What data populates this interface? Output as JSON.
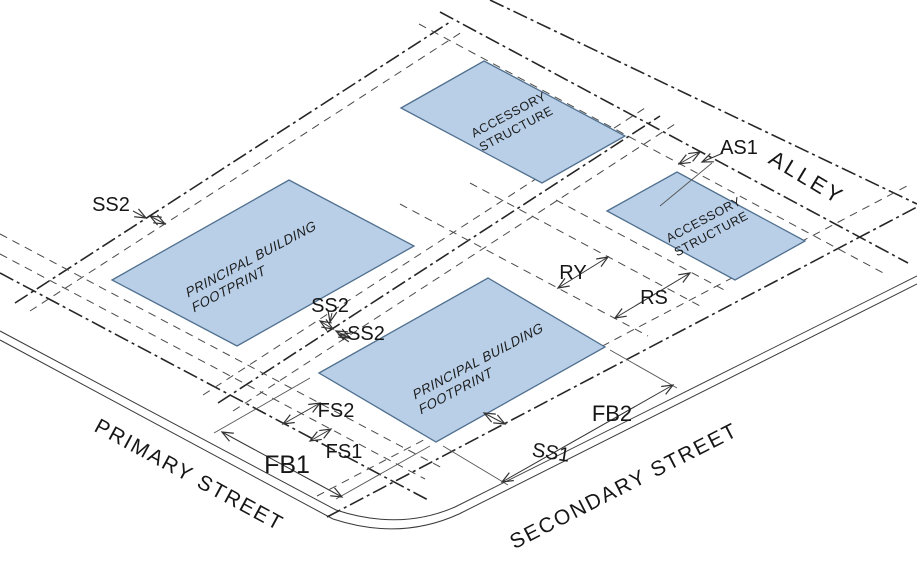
{
  "diagram": {
    "streets": {
      "primary": "PRIMARY STREET",
      "secondary": "SECONDARY STREET",
      "alley": "ALLEY"
    },
    "buildings": {
      "principal_left": {
        "line1": "PRINCIPAL BUILDING",
        "line2": "FOOTPRINT"
      },
      "principal_corner": {
        "line1": "PRINCIPAL BUILDING",
        "line2": "FOOTPRINT"
      },
      "accessory_rear": {
        "line1": "ACCESSORY",
        "line2": "STRUCTURE"
      },
      "accessory_corner": {
        "line1": "ACCESSORY",
        "line2": "STRUCTURE"
      }
    },
    "dimensions": {
      "ss2_left": "SS2",
      "ss2_mid_upper": "SS2",
      "ss2_mid_lower": "SS2",
      "fs1": "FS1",
      "fs2": "FS2",
      "fb1": "FB1",
      "fb2": "FB2",
      "ss1": "SS1",
      "ry": "RY",
      "rs": "RS",
      "as1": "AS1"
    },
    "colors": {
      "building_fill": "#b9cfe7",
      "building_stroke": "#50708f",
      "line": "#2b2b2b"
    }
  }
}
